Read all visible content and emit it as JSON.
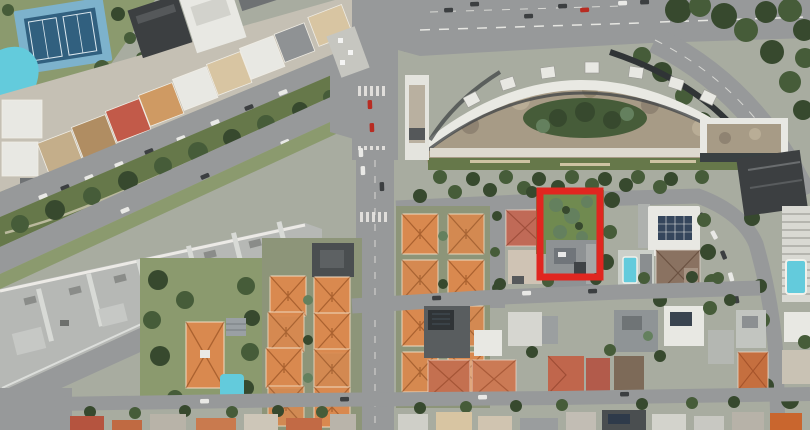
{
  "meta": {
    "type": "satellite-aerial-photo",
    "description": "Aerial satellite view of an urban district: a curved crescent apartment complex beside a wide avenue at top right, a diagonal tree-lined boulevard with a long gray-roofed building at left, a tennis court and swimming pool at upper left, grids of orange-roofed villas below, and a vacant green lot outlined with a red rectangle annotation right of center."
  },
  "canvas": {
    "width": 810,
    "height": 430
  },
  "annotation": {
    "name": "red-annotation-rectangle",
    "shape": "rectangle",
    "x": 540,
    "y": 191,
    "width": 60,
    "height": 86,
    "stroke_color": "#e02620",
    "stroke_width": 7
  },
  "colors": {
    "ground": "#a8aca0",
    "road": "#97999a",
    "road-light": "#bcbcb8",
    "grass": "#8b9a6e",
    "grass-dark": "#66784a",
    "tree": "#465c39",
    "tree-dark": "#37492e",
    "tree-light": "#64805e",
    "orange-roof": "#d9894f",
    "orange-roof-dark": "#bf6e3f",
    "red-roof": "#c25a49",
    "tan-roof": "#c4ae8a",
    "beige-roof": "#d8c5a2",
    "white-bldg": "#e8e8e3",
    "gray-bldg": "#b6b8b5",
    "dark-bldg": "#3c3f41",
    "tennis-outer": "#7db2cc",
    "tennis-inner": "#31607f",
    "pool": "#63cbdc",
    "crescent-floor": "#a79b86",
    "crescent-dark": "#303436"
  },
  "features": [
    "tennis-court",
    "swimming-pool",
    "park-trees",
    "highrise-cluster",
    "shopping-strip-roofs",
    "boulevard-road-upper",
    "median-park",
    "boulevard-road-lower",
    "long-gray-building",
    "road-below-gray-building",
    "street-intersection",
    "traffic-island",
    "north-south-street",
    "top-road",
    "tree-lined-curving-road",
    "crescent-apartment-building",
    "crescent-courtyard-garden",
    "right-dark-tower",
    "ribbed-highrise-facade",
    "rooftop-pool",
    "orange-villa-grid",
    "villa-garden-block",
    "pink-roof-villa",
    "vacant-green-lot",
    "gray-roof-inside-annotation",
    "solar-roof-house",
    "brown-roof-house",
    "residential-street-middle",
    "residential-street-bottom",
    "bottom-edge-rooftops",
    "red-annotation-rectangle"
  ]
}
